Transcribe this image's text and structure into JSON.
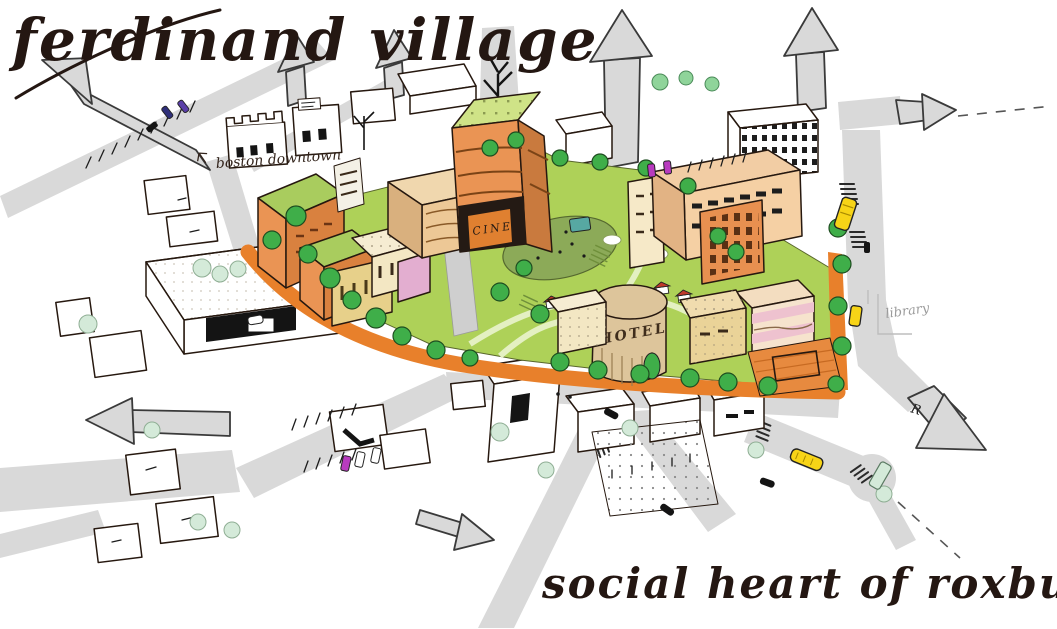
{
  "title": "ferdinand village",
  "caption": "social heart of roxbury",
  "annotations": {
    "boston_downtown": "boston downtown",
    "library": "library",
    "road_letter": "R"
  },
  "site_labels": {
    "cinema_sign": "CINE",
    "hotel_sign": "HOTEL"
  },
  "palette": {
    "ink": "#241712",
    "road_gray": "#d9d9d9",
    "street_orange": "#e8802b",
    "lawn_green": "#aed158",
    "mound_olive": "#8caa58",
    "tree_green": "#3fae49",
    "tree_pale": "#d4ead9",
    "building_orange": "#ea9454",
    "building_peach": "#f5d0a4",
    "building_cream": "#f6ecd2",
    "building_pink": "#eec2cf",
    "building_tan": "#ddc59b",
    "roof_green": "#b5d96b",
    "bus_yellow": "#f7d417",
    "car_magenta": "#b83bbf"
  }
}
